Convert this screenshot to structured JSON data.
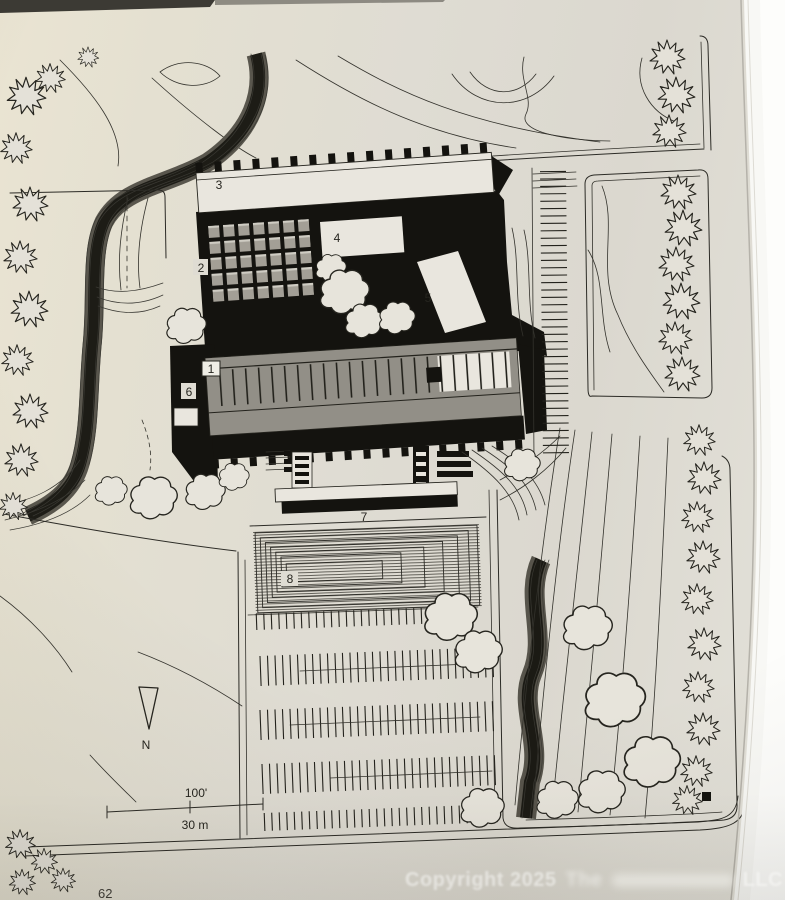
{
  "page": {
    "number": "62"
  },
  "watermark": {
    "prefix": "Copyright 2025",
    "middle": "The",
    "suffix": "LLC"
  },
  "plan": {
    "building_labels": [
      "1",
      "2",
      "3",
      "4",
      "5",
      "6",
      "7",
      "8"
    ],
    "north_label": "N",
    "scale": {
      "imperial": "100'",
      "metric": "30 m"
    },
    "colors": {
      "paper": "#e0ddd4",
      "ink": "#2c2b26",
      "shadow_black": "#14130f",
      "building_grey": "#928f87",
      "page_edge": "#f8f8f5"
    }
  }
}
